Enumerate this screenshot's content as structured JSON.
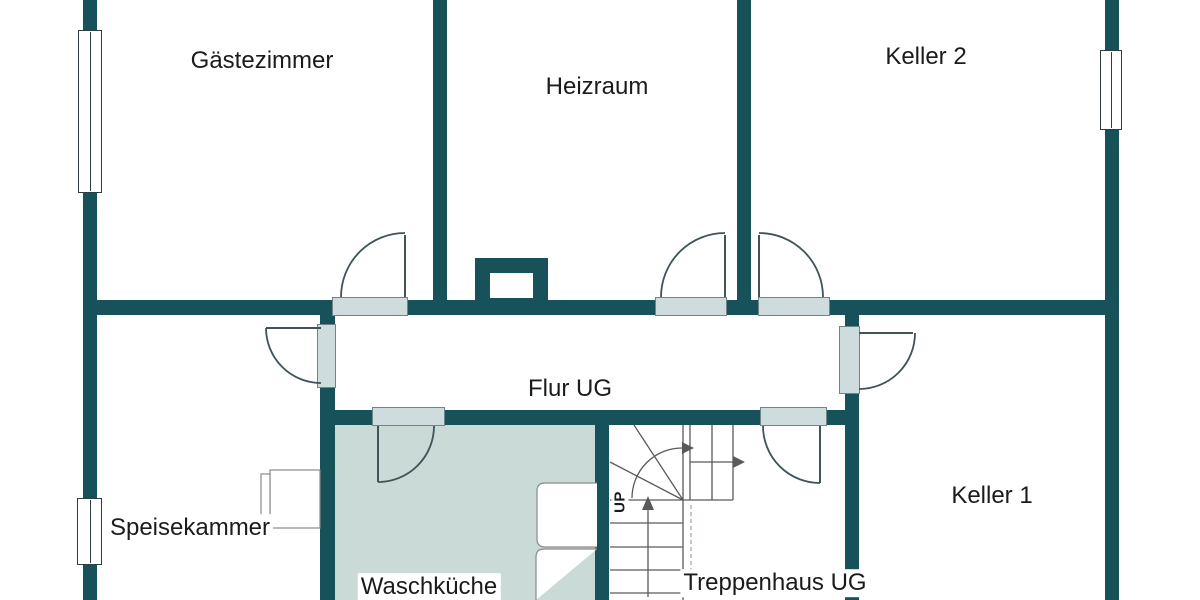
{
  "document": {
    "type": "floor-plan",
    "floor_label": "UG"
  },
  "rooms": {
    "gaestezimmer": {
      "label": "Gästezimmer"
    },
    "heizraum": {
      "label": "Heizraum"
    },
    "keller2": {
      "label": "Keller 2"
    },
    "flur": {
      "label": "Flur UG"
    },
    "speisekammer": {
      "label": "Speisekammer"
    },
    "waschkueche": {
      "label": "Waschküche"
    },
    "treppenhaus": {
      "label": "Treppenhaus UG"
    },
    "keller1": {
      "label": "Keller 1"
    }
  },
  "stairs": {
    "up_label": "UP"
  },
  "features": {
    "windows": 3,
    "doors": 7,
    "chimney": 1
  },
  "colors": {
    "wall": "#175159",
    "door_sill": "#cfdcdd",
    "room_shading": "#c9dad7",
    "line": "#3e5458",
    "stair_line": "#5a5a5a",
    "furniture_line": "#8a8a8a",
    "text": "#1b1b1b",
    "background": "#ffffff"
  }
}
